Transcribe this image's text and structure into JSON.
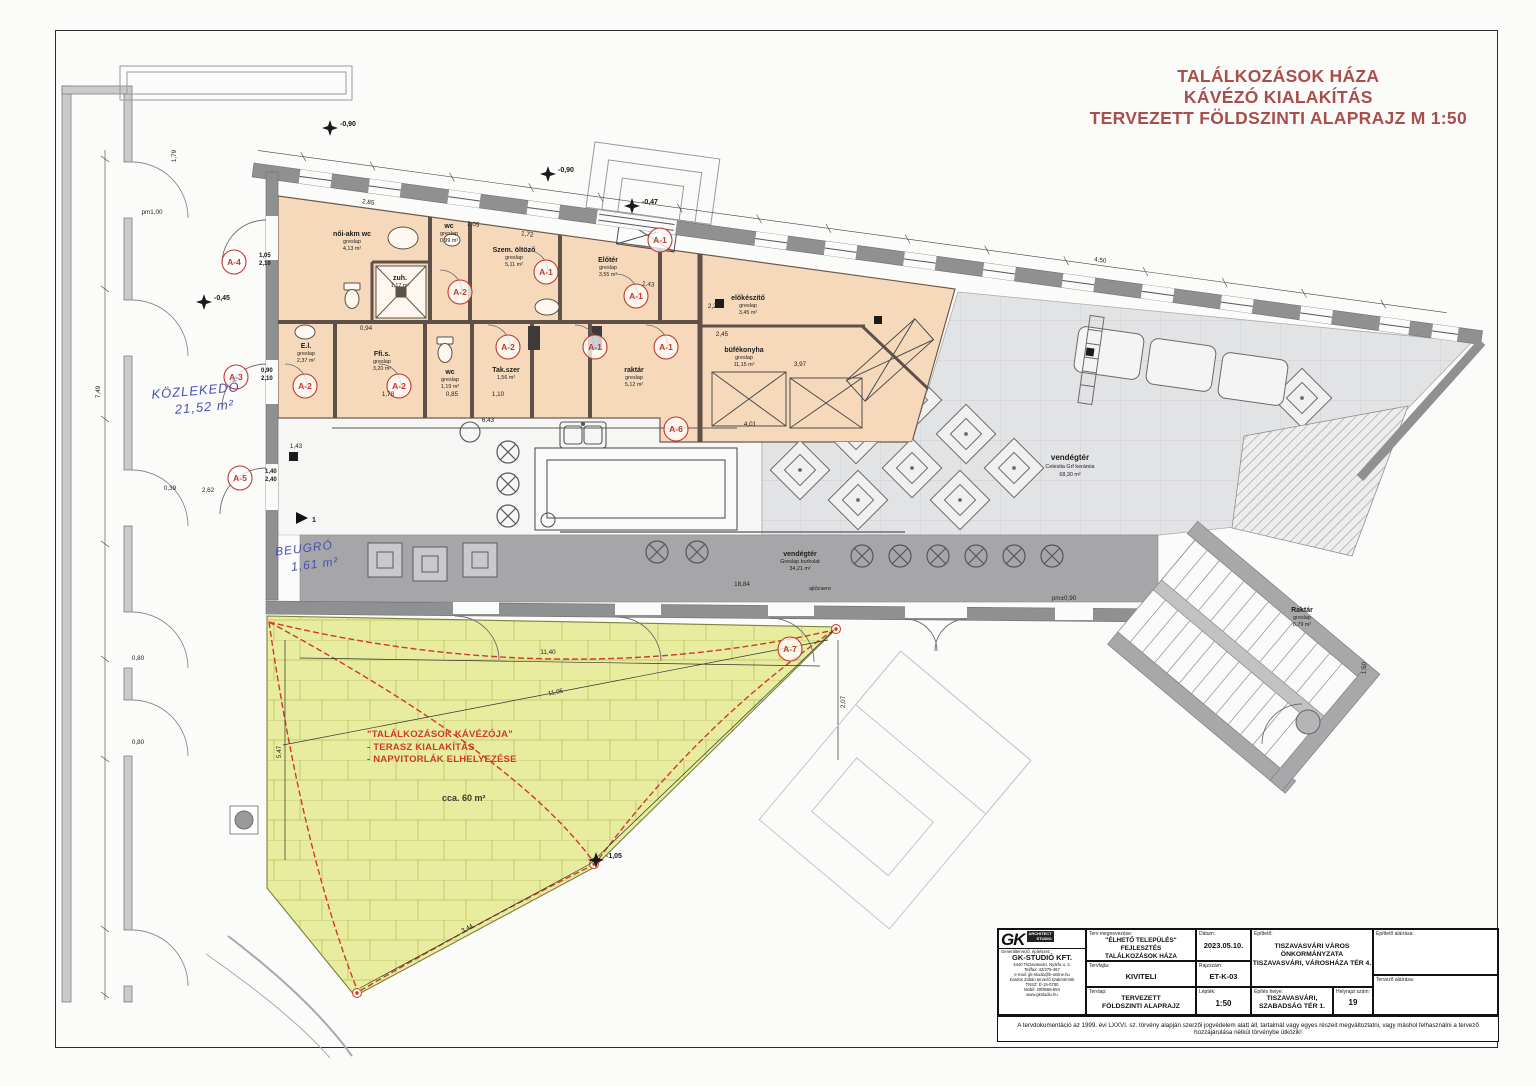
{
  "title": {
    "lines": [
      "TALÁLKOZÁSOK HÁZA",
      "KÁVÉZÓ KIALAKÍTÁS",
      "TERVEZETT FÖLDSZINTI ALAPRAJZ M 1:50"
    ],
    "color": "#a84f4b"
  },
  "notes": [
    {
      "line1": "KÖZLEKEDŐ",
      "line2": "21,52 m²"
    },
    {
      "line1": "BEUGRÓ",
      "line2": "1,61 m²"
    }
  ],
  "terrace": {
    "note_lines": [
      "\"TALÁLKOZÁSOK KÁVÉZÓJA\"",
      "- TERASZ KIALAKÍTÁS",
      "- NAPVITORLÁK ELHELYEZÉSE"
    ],
    "area": "cca. 60 m²"
  },
  "rooms": [
    {
      "name": "női-akm wc",
      "finish": "greslap",
      "area": "4,13 m²"
    },
    {
      "name": "wc",
      "finish": "greslap",
      "area": "0,99 m²"
    },
    {
      "name": "zuh.",
      "finish": "greslap",
      "area": "1,17 m²"
    },
    {
      "name": "E.l.",
      "finish": "greslap",
      "area": "2,37 m²"
    },
    {
      "name": "Ffi.s.",
      "finish": "greslap",
      "area": "3,20 m²"
    },
    {
      "name": "wc",
      "finish": "greslap",
      "area": "1,19 m²"
    },
    {
      "name": "Tak.szer",
      "finish": "greslap",
      "area": "1,56 m²"
    },
    {
      "name": "Szem. öltöző",
      "finish": "greslap",
      "area": "5,11 m²"
    },
    {
      "name": "Előtér",
      "finish": "greslap",
      "area": "3,55 m²"
    },
    {
      "name": "raktár",
      "finish": "greslap",
      "area": "5,12 m²"
    },
    {
      "name": "előkészítő",
      "finish": "greslap",
      "area": "3,45 m²"
    },
    {
      "name": "büfékonyha",
      "finish": "greslap",
      "area": "11,15 m²"
    },
    {
      "name": "vendégtér",
      "finish": "Celestia Grf kerámia",
      "area": "68,30 m²"
    },
    {
      "name": "vendégtér",
      "finish": "Greslap burkolat",
      "area": "34,21 m²"
    },
    {
      "name": "Raktár",
      "finish": "greslap",
      "area": "6,79 m²"
    }
  ],
  "door_markers": [
    {
      "id": "A-4",
      "w": "1,05",
      "h": "2,10"
    },
    {
      "id": "A-3",
      "w": "0,90",
      "h": "2,10"
    },
    {
      "id": "A-5",
      "w": "1,40",
      "h": "2,40"
    },
    {
      "id": "A-2"
    },
    {
      "id": "A-2"
    },
    {
      "id": "A-2"
    },
    {
      "id": "A-2"
    },
    {
      "id": "A-1"
    },
    {
      "id": "A-1"
    },
    {
      "id": "A-1"
    },
    {
      "id": "A-1"
    },
    {
      "id": "A-1"
    },
    {
      "id": "A-6"
    },
    {
      "id": "A-7"
    }
  ],
  "levels": [
    "-0,90",
    "-0,90",
    "-0,47",
    "-0,45",
    "-1,05"
  ],
  "dims": [
    "2,85",
    "1,72",
    "1,05",
    "1,43",
    "2,22",
    "2,45",
    "3,97",
    "4,01",
    "6,43",
    "1,78",
    "0,85",
    "1,10",
    "1,43",
    "2,62",
    "0,39",
    "7,49",
    "5,47",
    "11,40",
    "11,05",
    "2,07",
    "3,44",
    "18,84",
    "4,50",
    "1,50",
    "1,79",
    "0,80",
    "0,80",
    "pm±0,90",
    "0,94",
    "pm1,00"
  ],
  "misc": {
    "ajtocsere": "ajtócsere",
    "section": "1"
  },
  "titleblock": {
    "logo": {
      "gk": "GK",
      "studio1": "ARCHITECT",
      "studio2": "STUDIO"
    },
    "company": {
      "role": "Generáltervező, építészet:",
      "name": "GK-STUDIÓ KFT.",
      "lines": [
        "4440 Tiszavasvári, Nyárfa u. 3.",
        "Tel/fax: 42/275-467",
        "e-mail: gk-studio@k-online.hu",
        "Kardos Zoltán tervező szakmérnök",
        "TNSZ: É-15-0780",
        "Mobil: 30/9565-694",
        "www.gkstudio.hu"
      ]
    },
    "fields": {
      "terv": {
        "label": "Terv megnevezése:",
        "lines": [
          "\"ÉLHETŐ TELEPÜLÉS\" FEJLESZTÉS",
          "TALÁLKOZÁSOK HÁZA",
          "KÁVÉZÓ KIALAKÍTÁS"
        ]
      },
      "datum": {
        "label": "Dátum:",
        "value": "2023.05.10."
      },
      "tervfajta": {
        "label": "Tervfajta:",
        "value": "KIVITELI"
      },
      "rajzszam": {
        "label": "Rajzszám:",
        "value": "ET-K-03"
      },
      "tervlap": {
        "label": "Tervlap:",
        "lines": [
          "TERVEZETT",
          "FÖLDSZINTI ALAPRAJZ"
        ]
      },
      "leptek": {
        "label": "Lépték:",
        "value": "1:50"
      },
      "epitteto": {
        "label": "Építtető:",
        "lines": [
          "TISZAVASVÁRI VÁROS",
          "ÖNKORMÁNYZATA",
          "TISZAVASVÁRI, VÁROSHÁZA TÉR 4."
        ]
      },
      "epites_helye": {
        "label": "Építés helye:",
        "lines": [
          "TISZAVASVÁRI,",
          "SZABADSÁG TÉR 1."
        ]
      },
      "hrsz": {
        "label": "Helyrajzi szám:",
        "value": "19"
      },
      "epitteto_alairasa": {
        "label": "Építtető aláírása:"
      },
      "tervezo_alairasa": {
        "label": "Tervező aláírása:"
      }
    },
    "disclaimer": "A tervdokumentáció az 1999. évi LXXVI. sz. törvény alapján szerzői jogvédelem alatt áll, tartalmát vagy egyes részeit megváltoztatni, vagy máshol felhasználni a tervező hozzájárulása nélkül törvénybe ütközik!"
  }
}
